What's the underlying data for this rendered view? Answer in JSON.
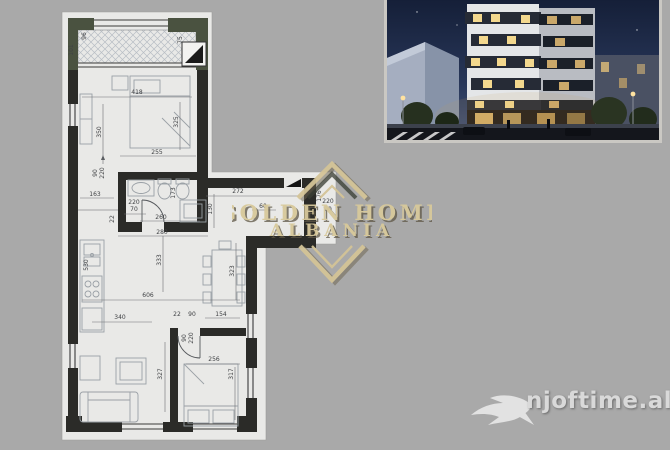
{
  "colors": {
    "background": "#a9a9a9",
    "paper": "#e9e9e7",
    "wall": "#2b2b28",
    "balcony_wall": "#4a5240",
    "watermark_gold": "#d4c497",
    "watermark_shadow": "#5f5846",
    "logo_text_color": "#d9d9d9"
  },
  "watermark": {
    "line1": "GOLDEN HOME",
    "line2": "ALBANIA"
  },
  "logo": {
    "text": "njoftime.al"
  },
  "floor_plan": {
    "labels": [
      {
        "t": "96",
        "x": 86,
        "y": 36,
        "r": 1
      },
      {
        "t": "101",
        "x": 73,
        "y": 50,
        "r": 1
      },
      {
        "t": "75",
        "x": 182,
        "y": 40,
        "r": 1
      },
      {
        "t": "418",
        "x": 137,
        "y": 94,
        "r": 0
      },
      {
        "t": "350",
        "x": 101,
        "y": 132,
        "r": 1
      },
      {
        "t": "325",
        "x": 178,
        "y": 122,
        "r": 1
      },
      {
        "t": "255",
        "x": 157,
        "y": 154,
        "r": 0
      },
      {
        "t": "90",
        "x": 97,
        "y": 173,
        "r": 1
      },
      {
        "t": "220",
        "x": 104,
        "y": 173,
        "r": 1
      },
      {
        "t": "163",
        "x": 95,
        "y": 196,
        "r": 0
      },
      {
        "t": "173",
        "x": 175,
        "y": 193,
        "r": 1
      },
      {
        "t": "220",
        "x": 134,
        "y": 204,
        "r": 0
      },
      {
        "t": "70",
        "x": 134,
        "y": 211,
        "r": 0
      },
      {
        "t": "22",
        "x": 114,
        "y": 219,
        "r": 1
      },
      {
        "t": "260",
        "x": 161,
        "y": 219,
        "r": 0
      },
      {
        "t": "280",
        "x": 162,
        "y": 234,
        "r": 0
      },
      {
        "t": "130",
        "x": 212,
        "y": 209,
        "r": 1
      },
      {
        "t": "272",
        "x": 238,
        "y": 193,
        "r": 0
      },
      {
        "t": "60",
        "x": 263,
        "y": 208,
        "r": 0
      },
      {
        "t": "176",
        "x": 321,
        "y": 196,
        "r": 1
      },
      {
        "t": "220",
        "x": 328,
        "y": 203,
        "r": 0
      },
      {
        "t": "90",
        "x": 328,
        "y": 211,
        "r": 0
      },
      {
        "t": "530",
        "x": 88,
        "y": 265,
        "r": 1
      },
      {
        "t": "333",
        "x": 161,
        "y": 260,
        "r": 1
      },
      {
        "t": "323",
        "x": 234,
        "y": 271,
        "r": 1
      },
      {
        "t": "606",
        "x": 148,
        "y": 297,
        "r": 0
      },
      {
        "t": "340",
        "x": 120,
        "y": 319,
        "r": 0
      },
      {
        "t": "22",
        "x": 177,
        "y": 316,
        "r": 0
      },
      {
        "t": "90",
        "x": 192,
        "y": 316,
        "r": 0
      },
      {
        "t": "154",
        "x": 221,
        "y": 316,
        "r": 0
      },
      {
        "t": "90",
        "x": 186,
        "y": 338,
        "r": 1
      },
      {
        "t": "220",
        "x": 193,
        "y": 338,
        "r": 1
      },
      {
        "t": "327",
        "x": 162,
        "y": 374,
        "r": 1
      },
      {
        "t": "256",
        "x": 214,
        "y": 361,
        "r": 0
      },
      {
        "t": "317",
        "x": 233,
        "y": 374,
        "r": 1
      }
    ]
  }
}
